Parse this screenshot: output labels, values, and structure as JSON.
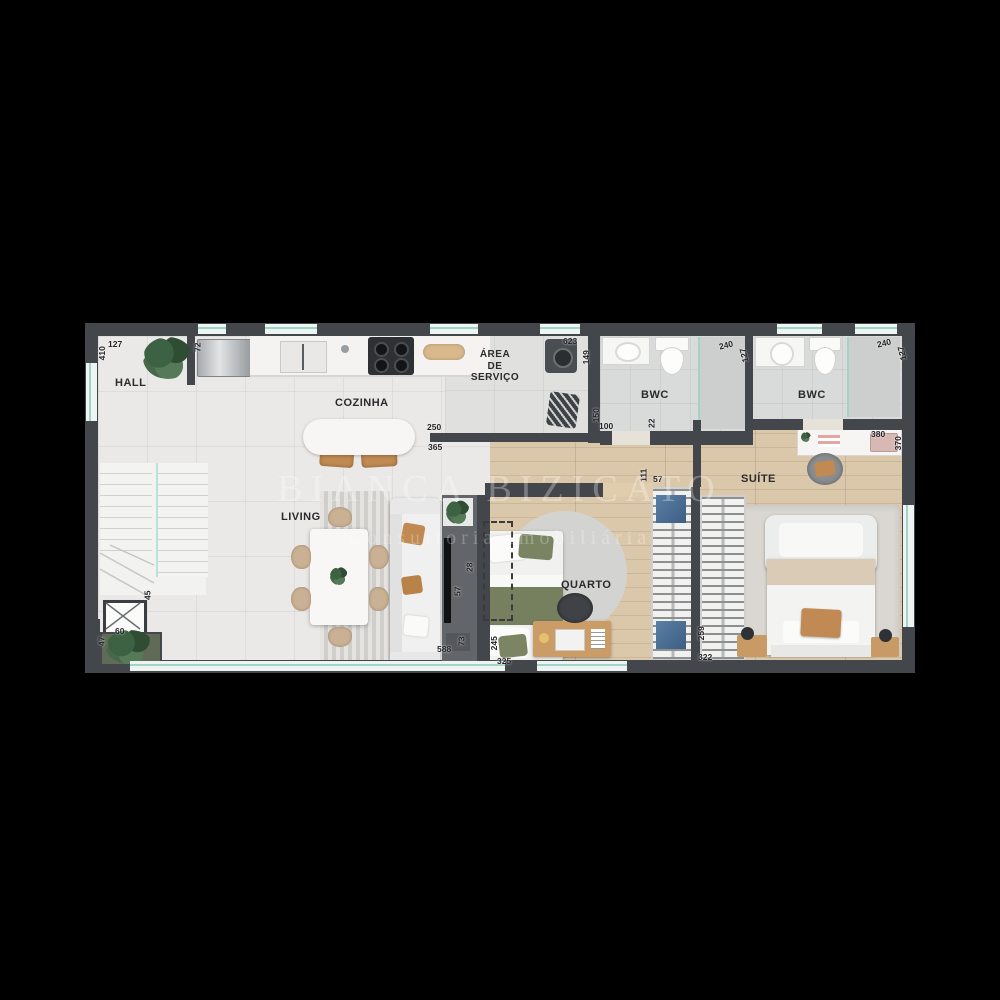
{
  "watermark": {
    "line1": "BIANCA BIZICATO",
    "line2": "Consultoria Imobiliária"
  },
  "rooms": {
    "hall": "HALL",
    "cozinha": "COZINHA",
    "area_servico_line1": "ÁREA",
    "area_servico_line2": "DE",
    "area_servico_line3": "SERVIÇO",
    "bwc1": "BWC",
    "bwc2": "BWC",
    "living": "LIVING",
    "quarto": "QUARTO",
    "suite": "SUÍTE"
  },
  "dimensions": {
    "hall_width": "127",
    "hall_depth": "410",
    "hall_cabinet": "72",
    "servico_width": "623",
    "servico_washer": "149",
    "kitchen_island_a": "250",
    "kitchen_island_b": "365",
    "bwc1_shower_a": "150",
    "bwc1_shower_b": "100",
    "bwc1_wall": "22",
    "bwc1_width": "240",
    "bwc1_depth": "127",
    "bwc2_width": "240",
    "bwc2_depth": "127",
    "suite_desk_a": "380",
    "suite_desk_b": "370",
    "quarto_closet_a": "111",
    "quarto_closet_b": "57",
    "tv_wall_a": "28",
    "tv_wall_b": "57",
    "shaft": "45",
    "planter_a": "60",
    "planter_b": "47",
    "living_span": "588",
    "living_wall": "73",
    "quarto_bed_a": "245",
    "quarto_span": "325",
    "suite_closet_a": "259",
    "suite_closet_b": "322"
  },
  "colors": {
    "background": "#000000",
    "walls": "#43464b",
    "tile_floor": "#e9e8e6",
    "wood_floor": "#dbc8aa",
    "glass_teal": "#9fd4c7",
    "wood_accent": "#c08a52",
    "olive_accent": "#76805f",
    "white_furniture": "#f4f4f2"
  }
}
